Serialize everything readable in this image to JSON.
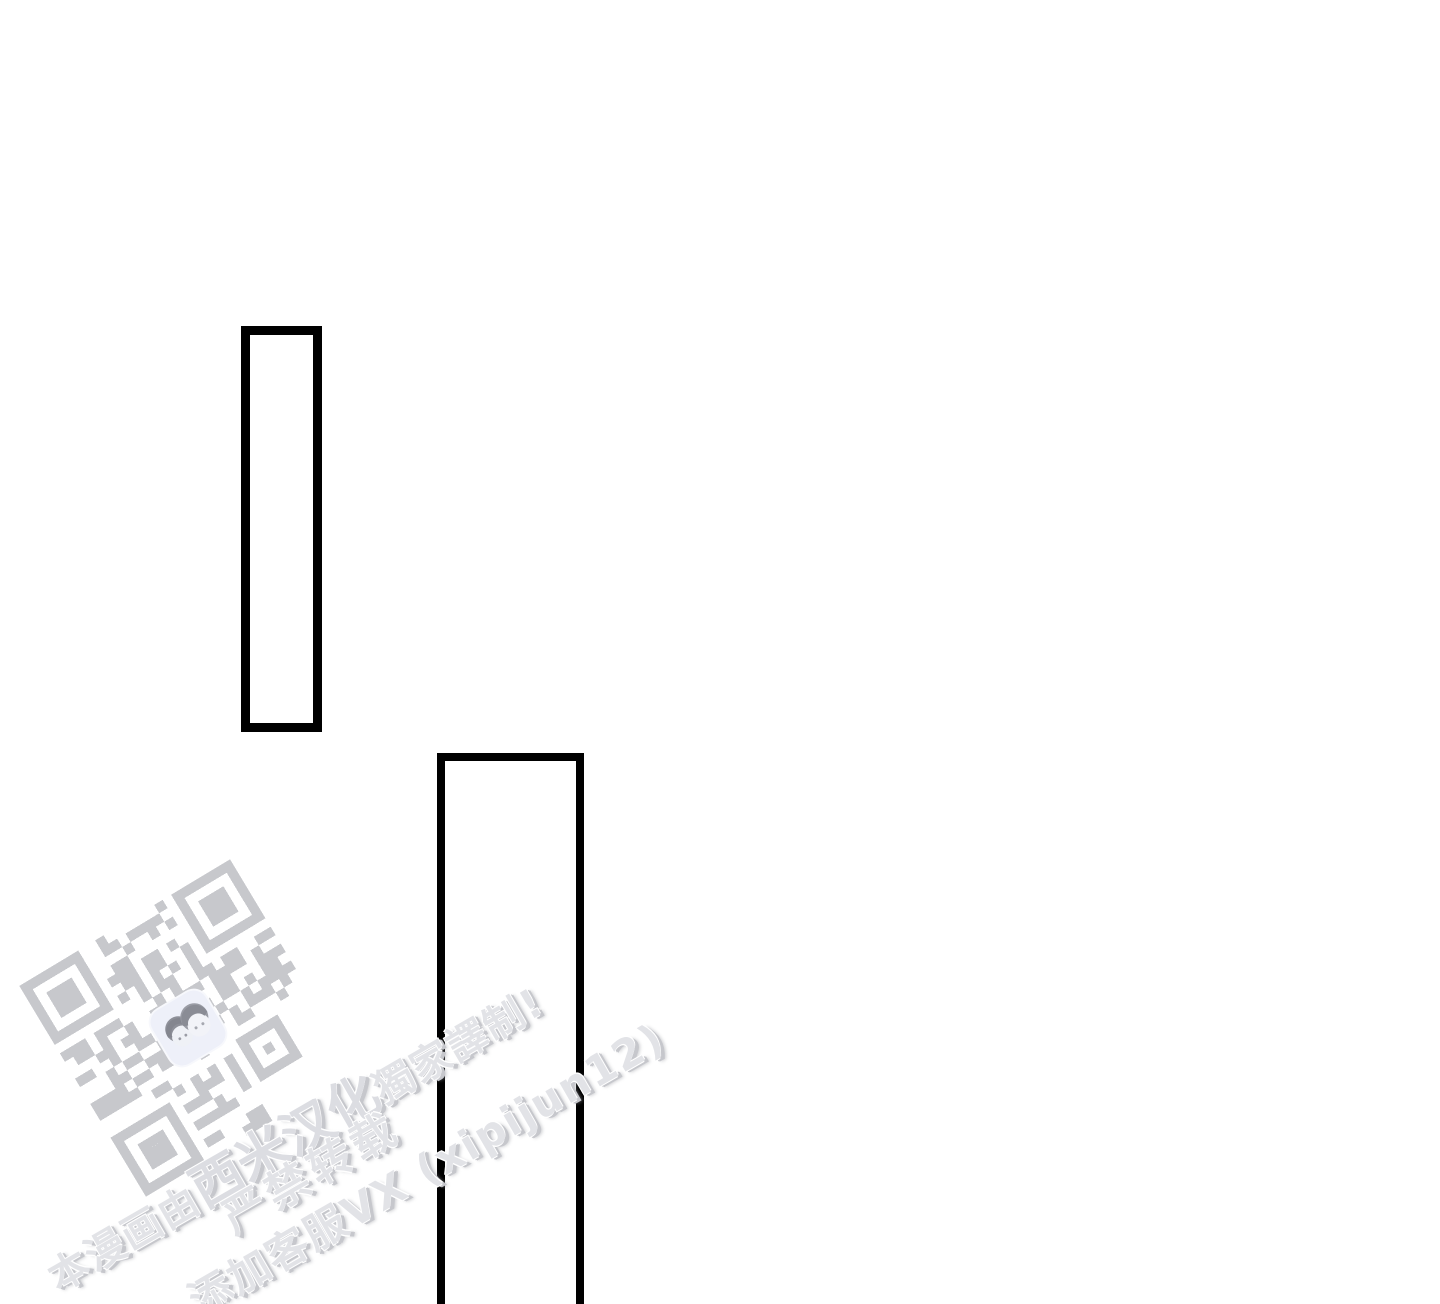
{
  "page": {
    "background_color": "#ffffff",
    "panel_border_color": "#000000"
  },
  "watermark": {
    "angle_deg": -30,
    "text_color": "#e2e3e7",
    "shadow_color": "#c6c7cc",
    "outline_color": "#ffffff",
    "line1": {
      "prefix": "本漫画由",
      "brand": "西米汉化",
      "suffix": "獨家譯制!"
    },
    "line2": "严禁转载",
    "line3": "添加客服VX (xipijun12)",
    "qr": {
      "color": "#c7c8cc",
      "modules": 25,
      "icon": "qr-code",
      "logo_icon": "two-faces-avatar",
      "logo_bg_color": "#eef0f9",
      "logo_hair_color": "#8e9099",
      "logo_face_color": "#eff1f6"
    }
  }
}
